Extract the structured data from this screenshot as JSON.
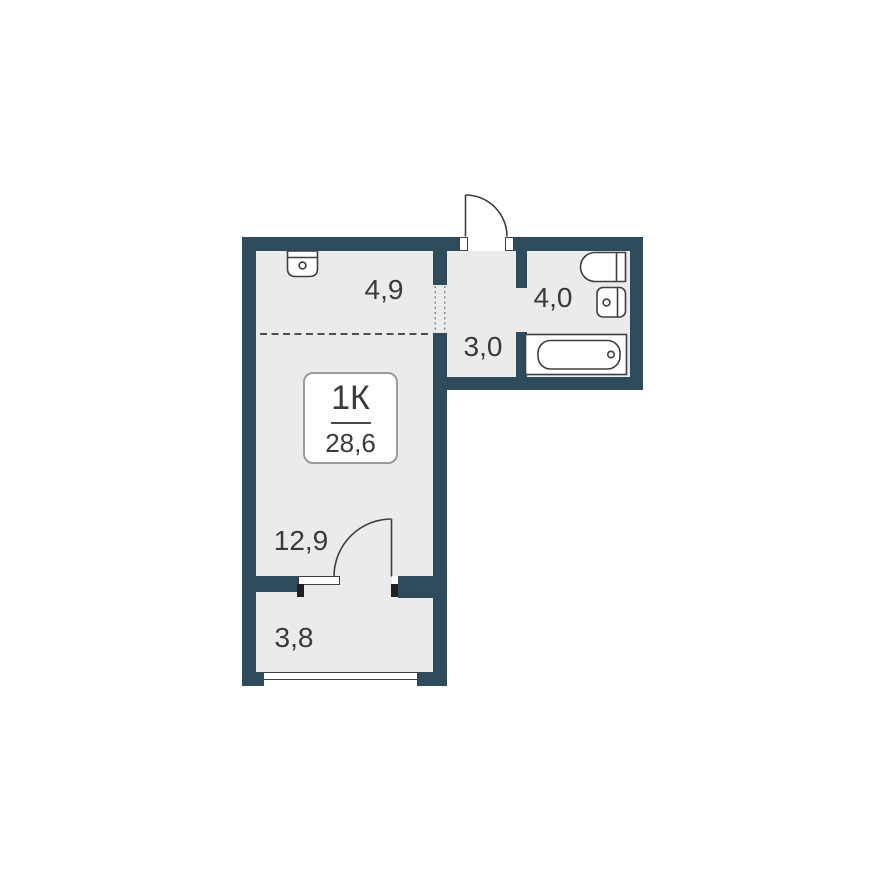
{
  "floor_plan": {
    "badge": {
      "unit_type": "1К",
      "total_area": "28,6"
    },
    "room_areas": {
      "kitchen_zone": "4,9",
      "hallway": "3,0",
      "bathroom": "4,0",
      "living_zone": "12,9",
      "balcony": "3,8"
    },
    "colors": {
      "wall": "#2d4b5a",
      "floor": "#ebebeb",
      "fixture_outline": "#3f3f3f",
      "jamb_black": "#1f1f1f",
      "text": "#3a3a3a"
    }
  }
}
